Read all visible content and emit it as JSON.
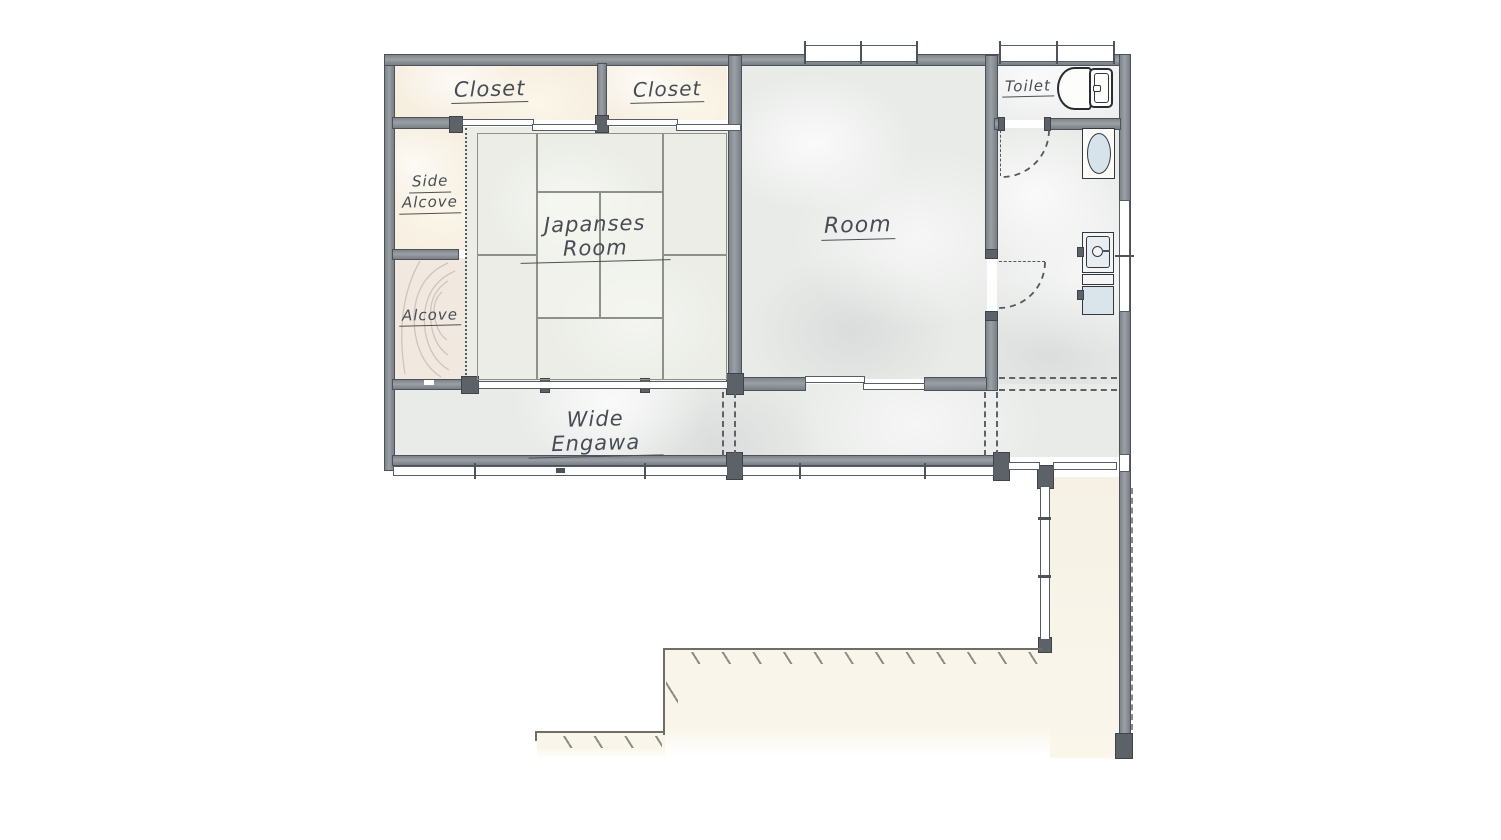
{
  "rooms": {
    "closet_left": {
      "label": "Closet"
    },
    "closet_right": {
      "label": "Closet"
    },
    "side_alcove": {
      "label_line1": "Side",
      "label_line2": "Alcove"
    },
    "alcove": {
      "label": "Alcove"
    },
    "japanese_room": {
      "label": "Japanses Room"
    },
    "room": {
      "label": "Room"
    },
    "toilet": {
      "label": "Toilet"
    },
    "wide_engawa": {
      "label": "Wide Engawa"
    }
  },
  "icons": [
    "toilet-fixture-icon",
    "sink-basin-icon",
    "vanity-sink-icon",
    "door-swing-arc",
    "wood-grain",
    "tatami-grid",
    "step-hatching"
  ],
  "colors": {
    "wall": "#8a9095",
    "post": "#5d6268",
    "closet_cream": "#f6eedf",
    "floor_gray": "#e9ebe9",
    "tatami": "#ebede6",
    "terrace_cream": "#f9f5ea",
    "fixture_blue": "#d6e3ea",
    "label_ink": "#484d55"
  }
}
